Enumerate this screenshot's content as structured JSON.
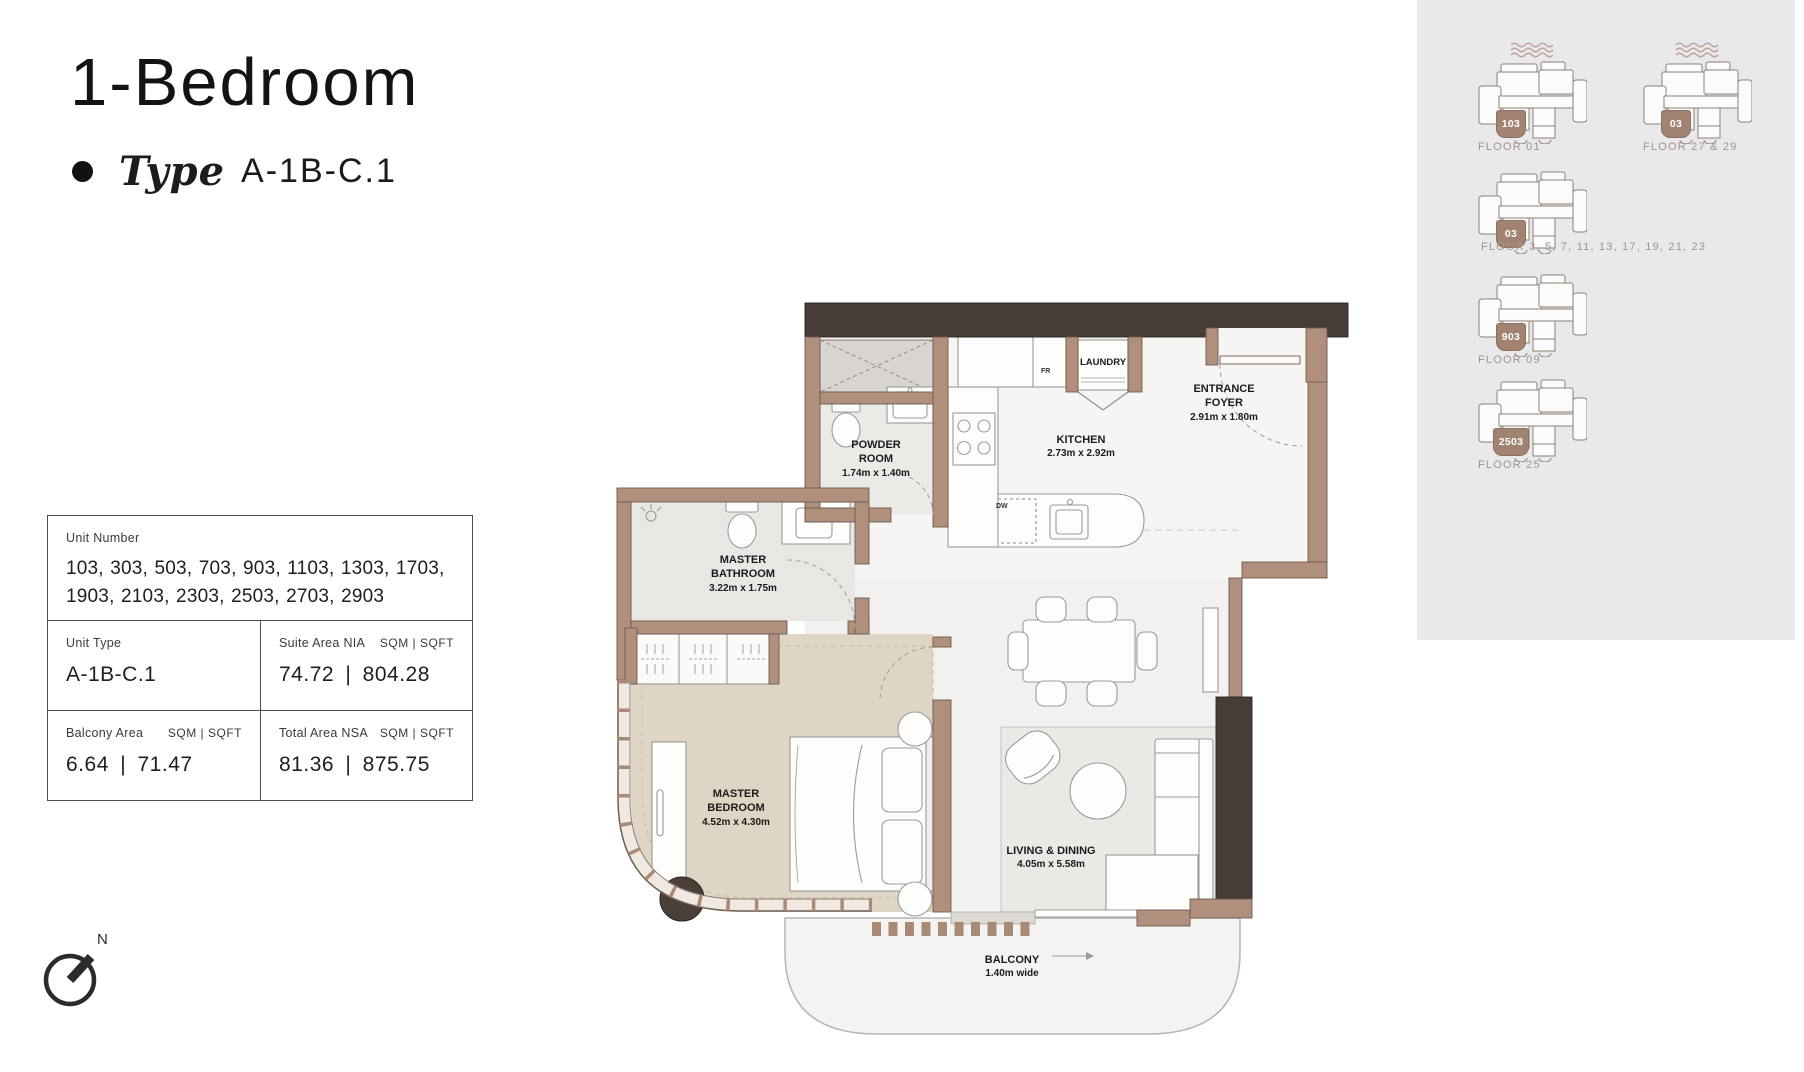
{
  "header": {
    "title": "1-Bedroom",
    "type_label": "Type",
    "type_value": "A-1B-C.1"
  },
  "info_table": {
    "unit_number_label": "Unit Number",
    "unit_numbers": "103, 303, 503, 703, 903, 1103, 1303, 1703, 1903, 2103, 2303, 2503, 2703, 2903",
    "unit_type_label": "Unit Type",
    "unit_type_value": "A-1B-C.1",
    "suite_area_label": "Suite Area NIA",
    "suite_area_units": "SQM | SQFT",
    "suite_area_value": "74.72 | 804.28",
    "balcony_area_label": "Balcony Area",
    "balcony_area_units": "SQM | SQFT",
    "balcony_area_value": "6.64 | 71.47",
    "total_area_label": "Total Area NSA",
    "total_area_units": "SQM | SQFT",
    "total_area_value": "81.36 | 875.75"
  },
  "floor_plan": {
    "rooms": {
      "powder_room": {
        "name": "POWDER ROOM",
        "dims": "1.74m x 1.40m"
      },
      "kitchen": {
        "name": "KITCHEN",
        "dims": "2.73m x 2.92m"
      },
      "laundry": {
        "name": "LAUNDRY"
      },
      "entrance_foyer": {
        "name": "ENTRANCE FOYER",
        "dims": "2.91m x 1.80m"
      },
      "master_bathroom": {
        "name": "MASTER BATHROOM",
        "dims": "3.22m x 1.75m"
      },
      "master_bedroom": {
        "name": "MASTER BEDROOM",
        "dims": "4.52m x 4.30m"
      },
      "living_dining": {
        "name": "LIVING & DINING",
        "dims": "4.05m x 5.58m"
      },
      "balcony": {
        "name": "BALCONY",
        "dims": "1.40m wide"
      }
    },
    "appliances": {
      "fridge": "FR",
      "dishwasher": "DW"
    }
  },
  "key_plans": {
    "items": [
      {
        "unit": "103",
        "label": "FLOOR 01"
      },
      {
        "unit": "03",
        "label": "FLOOR 27 & 29"
      },
      {
        "unit": "03",
        "label": "FLOOR 3, 5, 7, 11, 13, 17, 19, 21, 23"
      },
      {
        "unit": "903",
        "label": "FLOOR 09"
      },
      {
        "unit": "2503",
        "label": "FLOOR 25"
      }
    ]
  },
  "compass": {
    "north_label": "N"
  },
  "colors": {
    "wall": "#b18f7d",
    "wall_outline": "#6b5b4f",
    "accent_dark": "#473d36",
    "bedroom_floor": "#ded5c4",
    "badge": "#a28270",
    "sidebar_bg": "#e9e8ea",
    "keyplan_label": "#a39488",
    "waves": "#c2a09b"
  }
}
